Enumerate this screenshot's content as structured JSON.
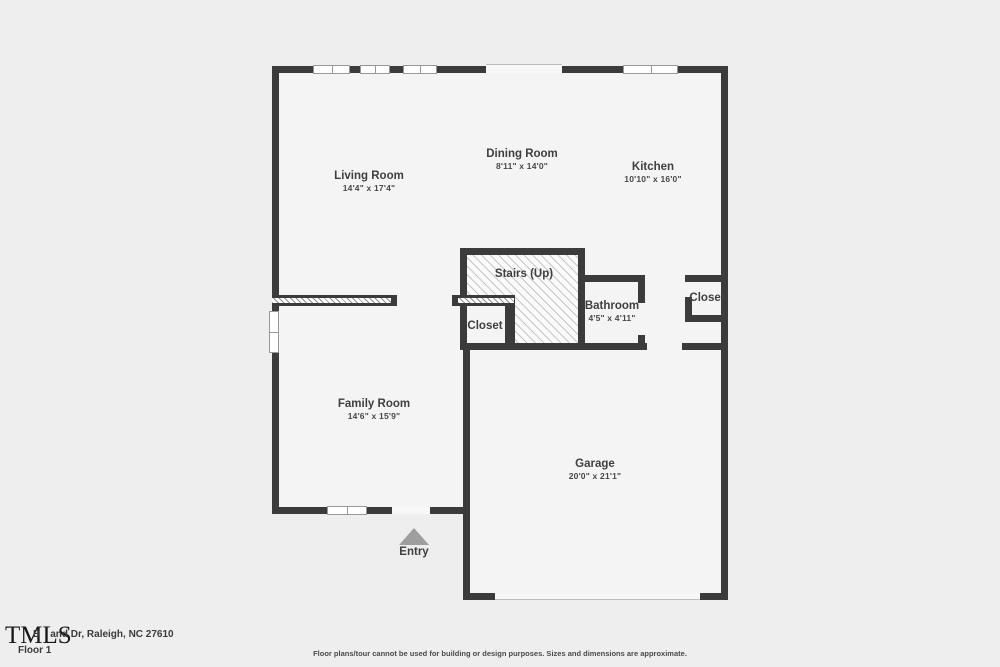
{
  "branding": {
    "logo": "TMLS",
    "address_prefix": "B",
    "address_rest": "and Dr, Raleigh, NC 27610",
    "floor_label": "Floor 1"
  },
  "disclaimer": "Floor plans/tour cannot be used for building or design purposes. Sizes and dimensions are approximate.",
  "colors": {
    "wall": "#3b3b3b",
    "floor": "#f4f4f4",
    "background": "#efeeef",
    "hatch_line": "#c6c6c6",
    "label_text": "#3f3f3f",
    "entry_marker": "#9e9e9e",
    "window_frame": "#989898"
  },
  "rooms": {
    "living": {
      "name": "Living Room",
      "dims": "14'4\" x 17'4\""
    },
    "dining": {
      "name": "Dining Room",
      "dims": "8'11\" x 14'0\""
    },
    "kitchen": {
      "name": "Kitchen",
      "dims": "10'10\" x 16'0\""
    },
    "stairs": {
      "name": "Stairs (Up)"
    },
    "closet_hall": {
      "name": "Closet"
    },
    "bathroom": {
      "name": "Bathroom",
      "dims": "4'5\" x 4'11\""
    },
    "closet_upper": {
      "name": "Closet"
    },
    "family": {
      "name": "Family Room",
      "dims": "14'6\" x 15'9\""
    },
    "garage": {
      "name": "Garage",
      "dims": "20'0\" x 21'1\""
    }
  },
  "entry": {
    "label": "Entry"
  }
}
